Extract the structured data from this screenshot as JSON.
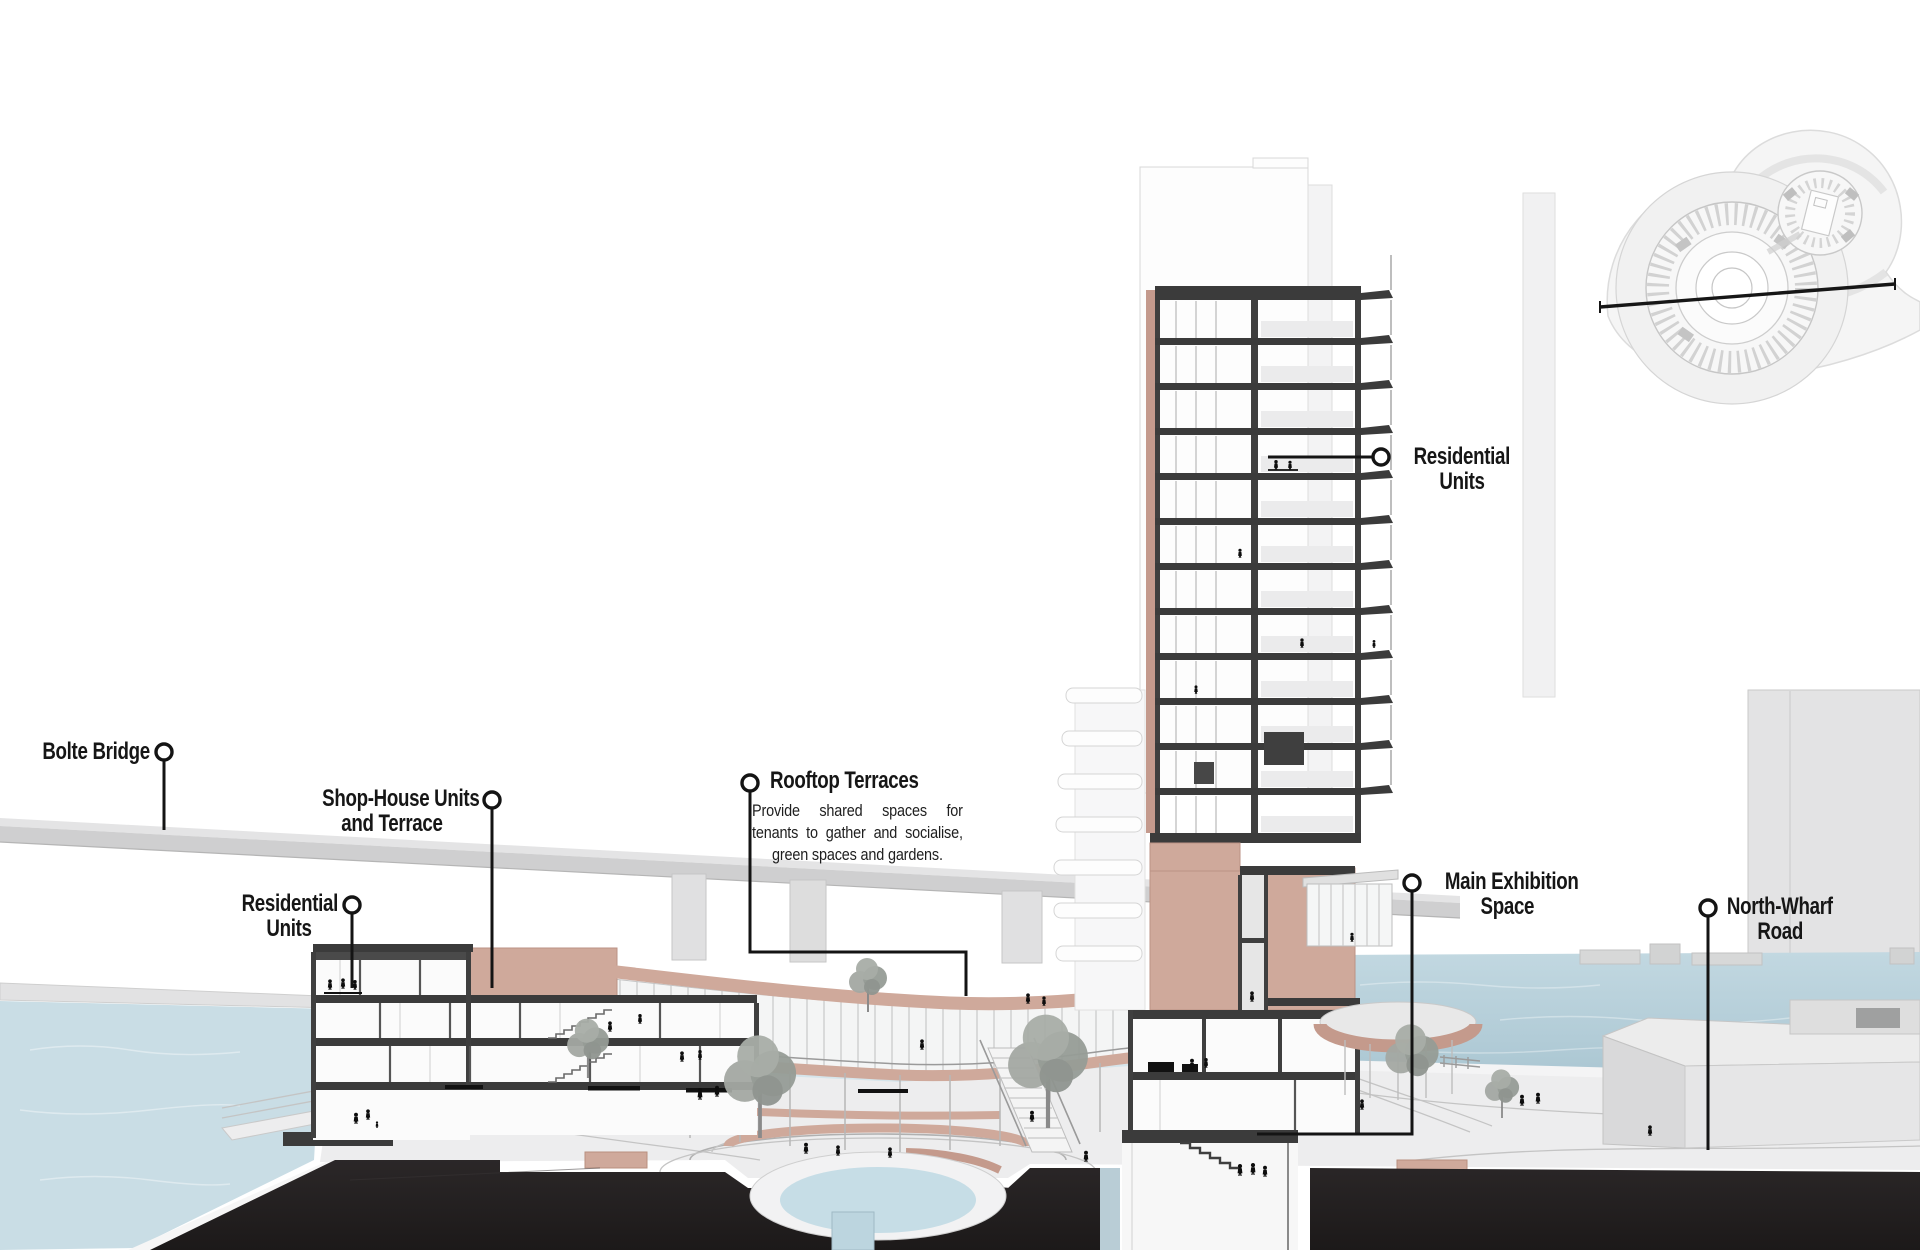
{
  "annotations": {
    "bolte_bridge": {
      "label": "Bolte Bridge"
    },
    "shop_house_units": {
      "line1": "Shop-House Units",
      "line2": "and Terrace"
    },
    "residential_units_left": {
      "line1": "Residential",
      "line2": "Units"
    },
    "rooftop_terraces": {
      "title": "Rooftop Terraces",
      "description": "Provide shared spaces for tenants to gather and socialise, green spaces and gardens."
    },
    "residential_units_right": {
      "line1": "Residential",
      "line2": "Units"
    },
    "main_exhibition_space": {
      "line1": "Main Exhibition",
      "line2": "Space"
    },
    "north_wharf_road": {
      "line1": "North-Wharf",
      "line2": "Road"
    }
  },
  "colors": {
    "ink": "#161616",
    "slab": "#3b3b3b",
    "salmon": "#cfa99b",
    "salmon-deep": "#c49a8c",
    "water": "#c9dde5",
    "water-deep": "#b4ced9",
    "concrete": "#d4d4d5",
    "ground": "#ededee",
    "earth": "#262223",
    "tree": "#9aa09a"
  }
}
